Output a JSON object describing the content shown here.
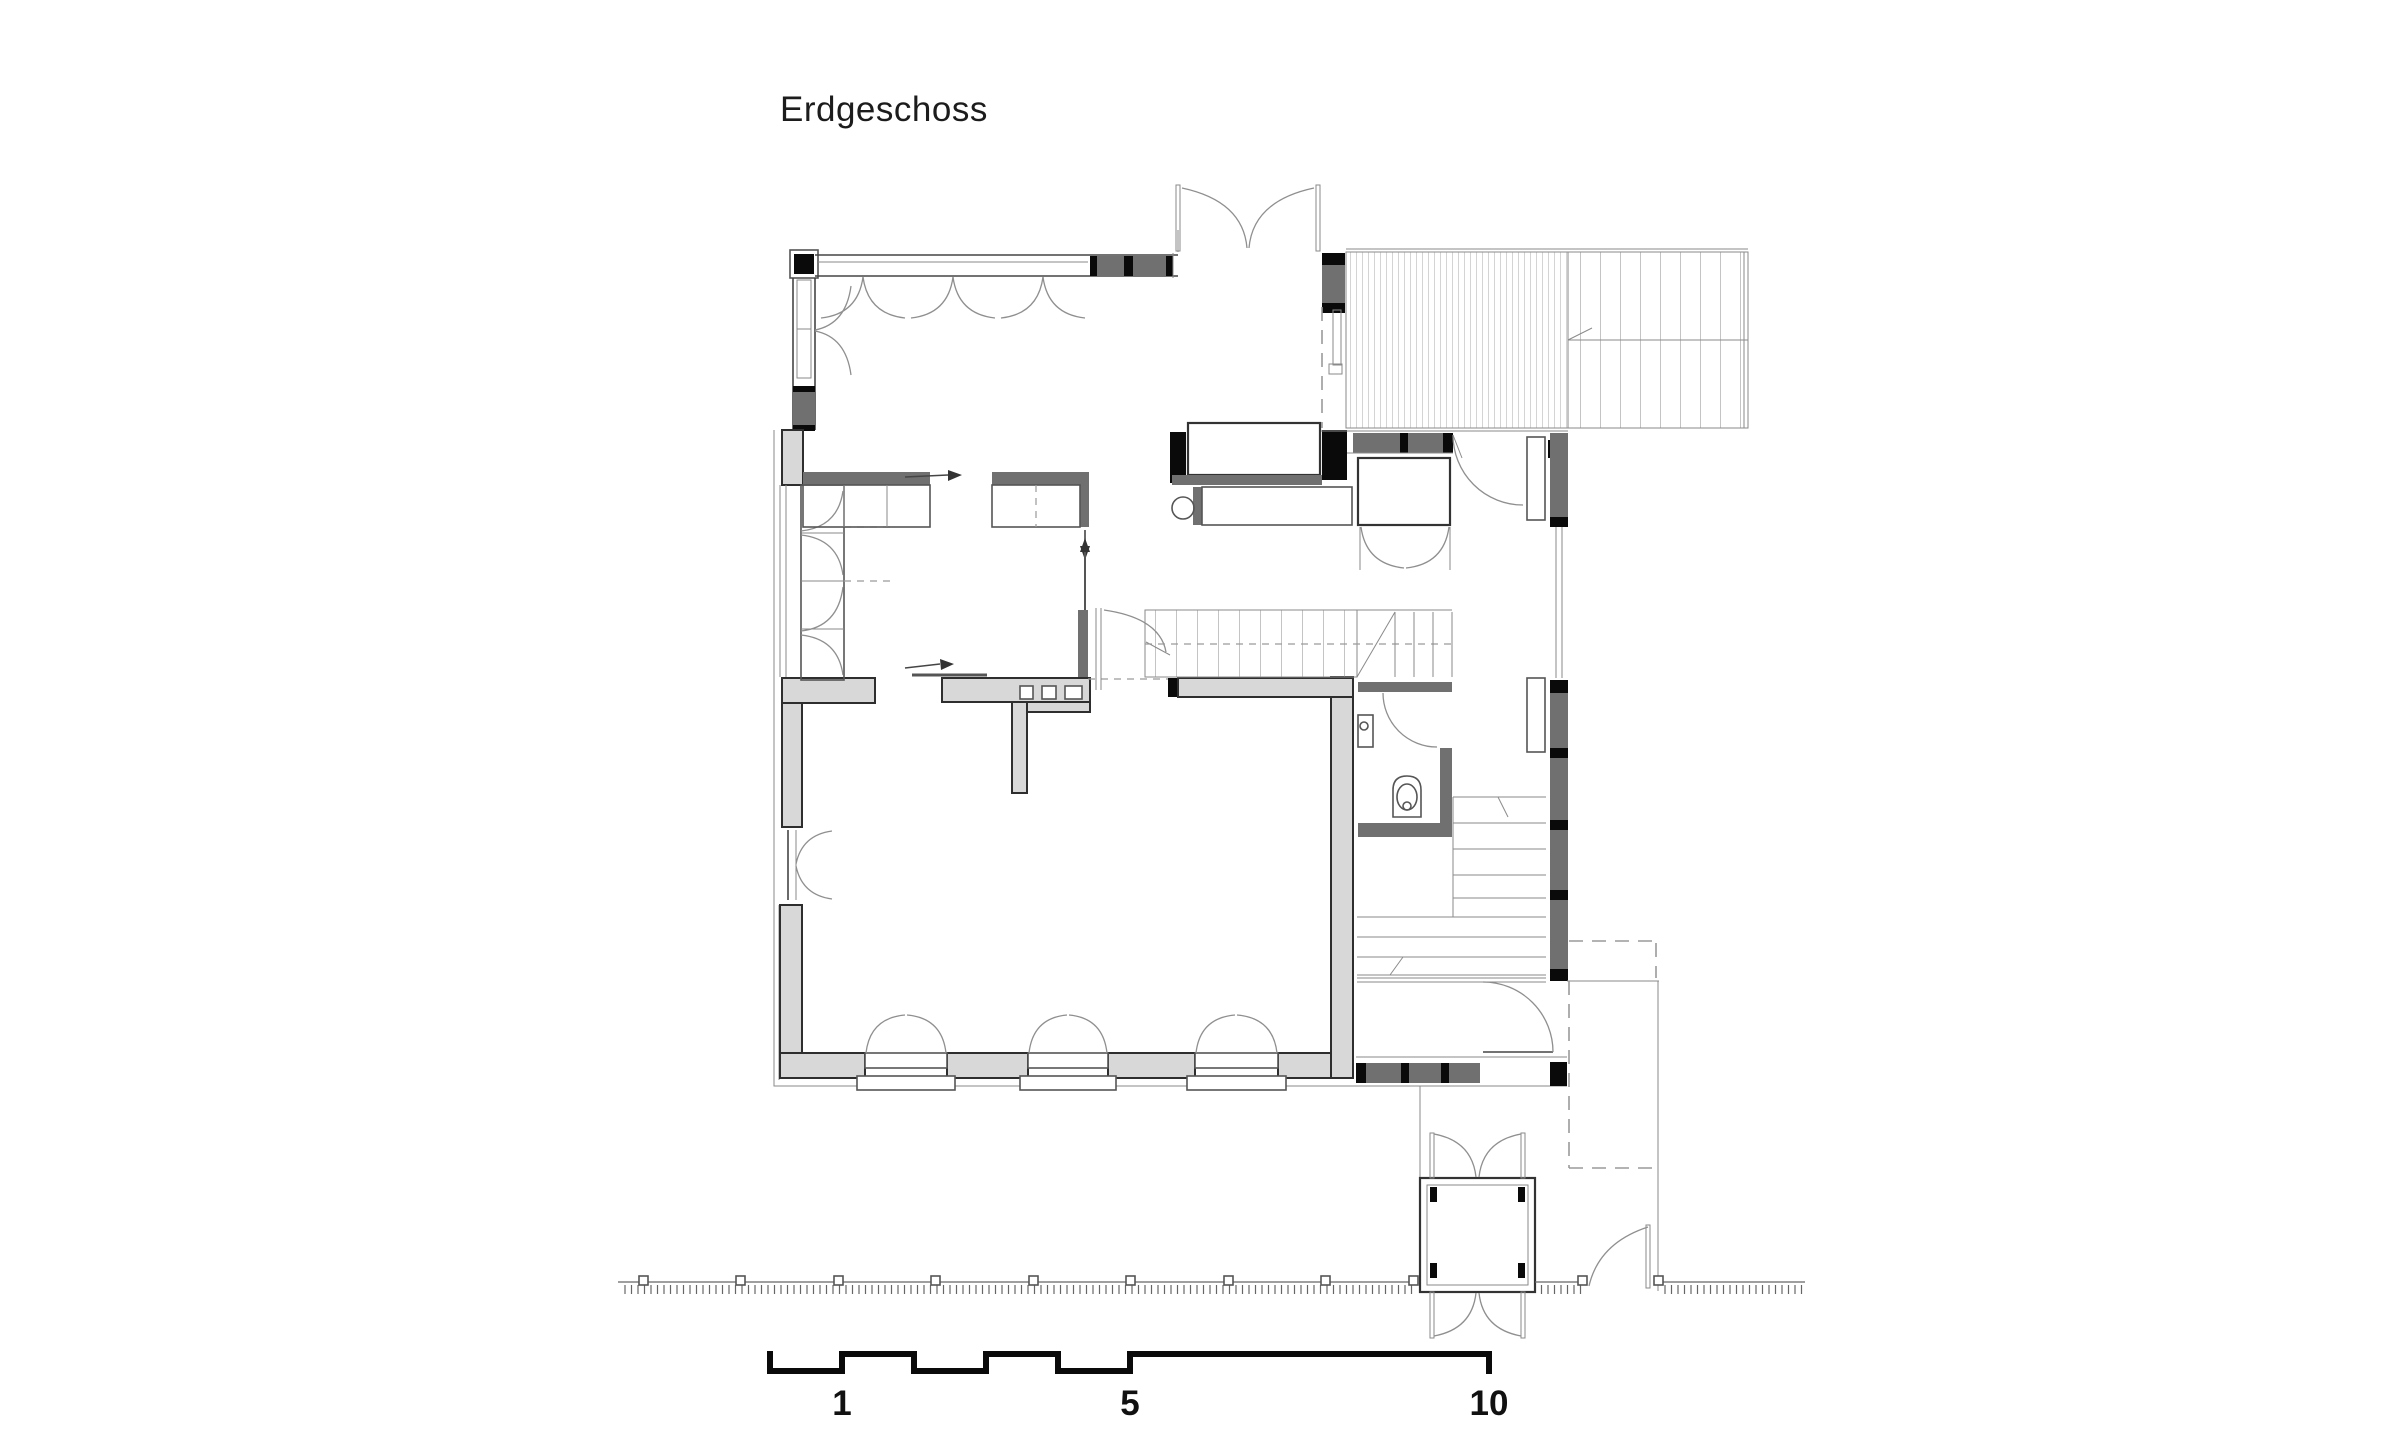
{
  "title": "Erdgeschoss",
  "scale_bar": {
    "tick_1": "1",
    "tick_5": "5",
    "tick_10": "10"
  },
  "colors": {
    "background": "#ffffff",
    "drawing_line": "#2e2e2e",
    "wall_fill_light": "#d8d8d8",
    "glazing_fill_dark": "#707070",
    "solid_black": "#0a0a0a",
    "hatch_gray": "#9a9a9a"
  }
}
